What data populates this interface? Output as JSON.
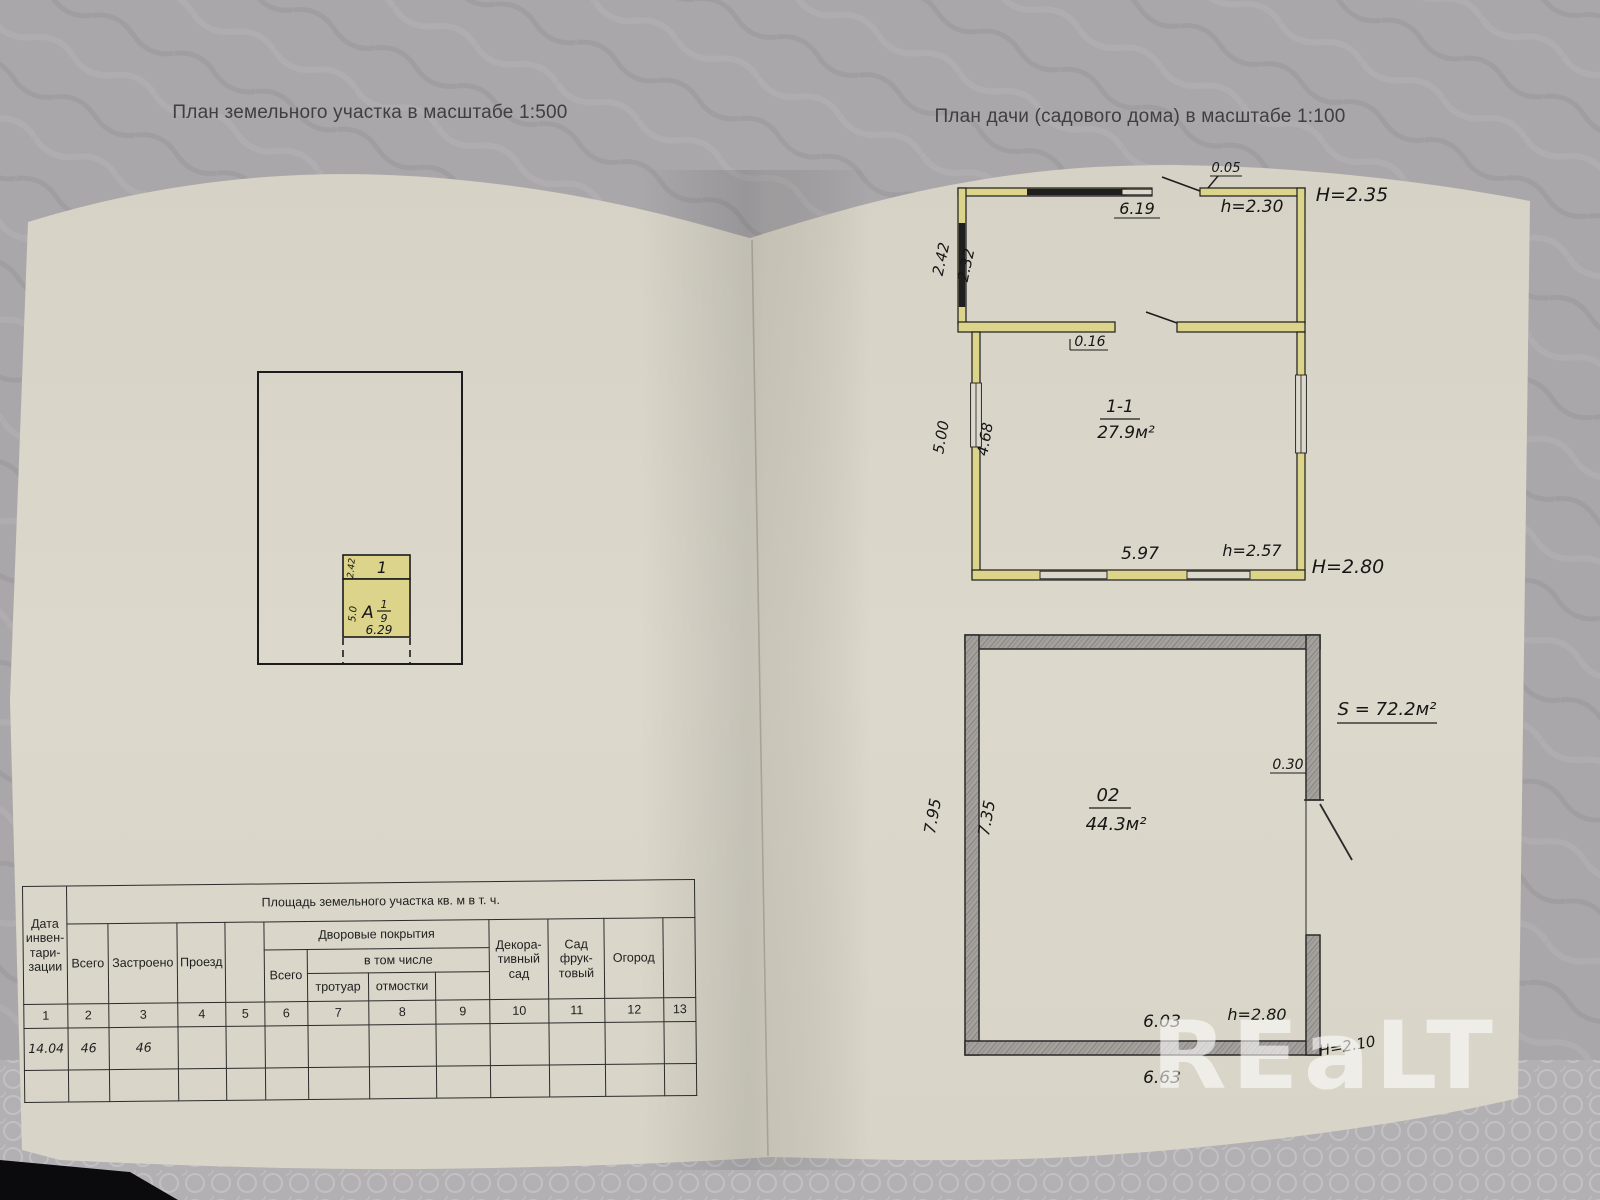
{
  "titles": {
    "site_plan": "План земельного участка в масштабе 1:500",
    "house_plan": "План дачи (садового дома) в масштабе 1:100"
  },
  "site_plan": {
    "building_number": "1",
    "veranda_width": "2.42",
    "litera": "А",
    "frac_top": "1",
    "frac_bottom": "9",
    "depth": "5.0",
    "width": "6.29"
  },
  "floor1": {
    "top_width": "6.19",
    "offset": "0.05",
    "h_veranda": "h=2.30",
    "H_veranda": "H=2.35",
    "veranda_out": "2.42",
    "veranda_in": "2.32",
    "door": "0.16",
    "room": "1-1",
    "area": "27.9м²",
    "side_out": "5.00",
    "side_in": "4.68",
    "bottom_width": "5.97",
    "h_room": "h=2.57",
    "H_room": "H=2.80"
  },
  "floor0": {
    "area_total": "S = 72.2м²",
    "door": "0.30",
    "room": "02",
    "area": "44.3м²",
    "side_out": "7.95",
    "side_in": "7.35",
    "bottom_in": "6.03",
    "h_room": "h=2.80",
    "bottom_out": "6.63",
    "H_room": "H=2.10"
  },
  "table": {
    "area_title": "Площадь земельного участка кв. м в т. ч.",
    "date_header": "Дата\nинвен-\nтари-\nзации",
    "total": "Всего",
    "built": "Застроено",
    "drive": "Проезд",
    "yard": "Дворовые покрытия",
    "yard_total": "Всего",
    "including": "в том числе",
    "sidewalk": "тротуар",
    "apron": "отмостки",
    "decorative": "Декора-\nтивный\nсад",
    "orchard": "Сад\nфрук-\nтовый",
    "garden": "Огород",
    "numbers": [
      "1",
      "2",
      "3",
      "4",
      "5",
      "6",
      "7",
      "8",
      "9",
      "10",
      "11",
      "12",
      "13"
    ],
    "data_row": [
      "14.04",
      "46",
      "46",
      "",
      "",
      "",
      "",
      "",
      "",
      "",
      "",
      "",
      ""
    ]
  },
  "watermark": "REaLT",
  "colors": {
    "paper": "#dad6ca",
    "highlight_yellow": "#dbd48a",
    "pencil_gray": "#9a9794",
    "ink": "#1c1c1c",
    "cloth": "#a9a7aa"
  }
}
